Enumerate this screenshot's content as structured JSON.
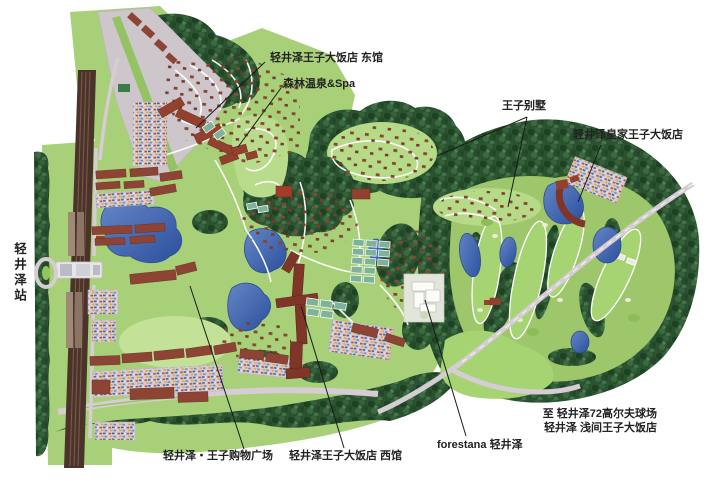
{
  "map": {
    "name": "轻井泽王子大饭店区域导览图",
    "type": "illustrated-resort-map"
  },
  "labels": {
    "east_wing": "轻井泽王子大饭店 东馆",
    "forest_spa": "森林温泉&Spa",
    "prince_villa": "王子别墅",
    "royal_prince_hotel": "轻井泽皇家王子大饭店",
    "station": "轻井泽站",
    "shopping_plaza": "轻井泽・王子购物广场",
    "west_wing": "轻井泽王子大饭店 西馆",
    "forestana": "forestana 轻井泽",
    "to_golf_line1": "至 轻井泽72高尔夫球场",
    "to_golf_line2": "轻井泽 浅间王子大饭店"
  },
  "colors": {
    "background": "#ffffff",
    "grass": "#a8d078",
    "lawn_light": "#c3e298",
    "forest_dark": "#2b5330",
    "fairway": "#a6d472",
    "pond_blue": "#2c4f9e",
    "road_gray": "#d5cdd3",
    "path_white": "#ffffff",
    "building_red": "#8d4434",
    "hotel_dark_red": "#7f3527",
    "railway_brown": "#4a332a",
    "parking_gray": "#cdc7cc",
    "label_text": "#222222"
  }
}
